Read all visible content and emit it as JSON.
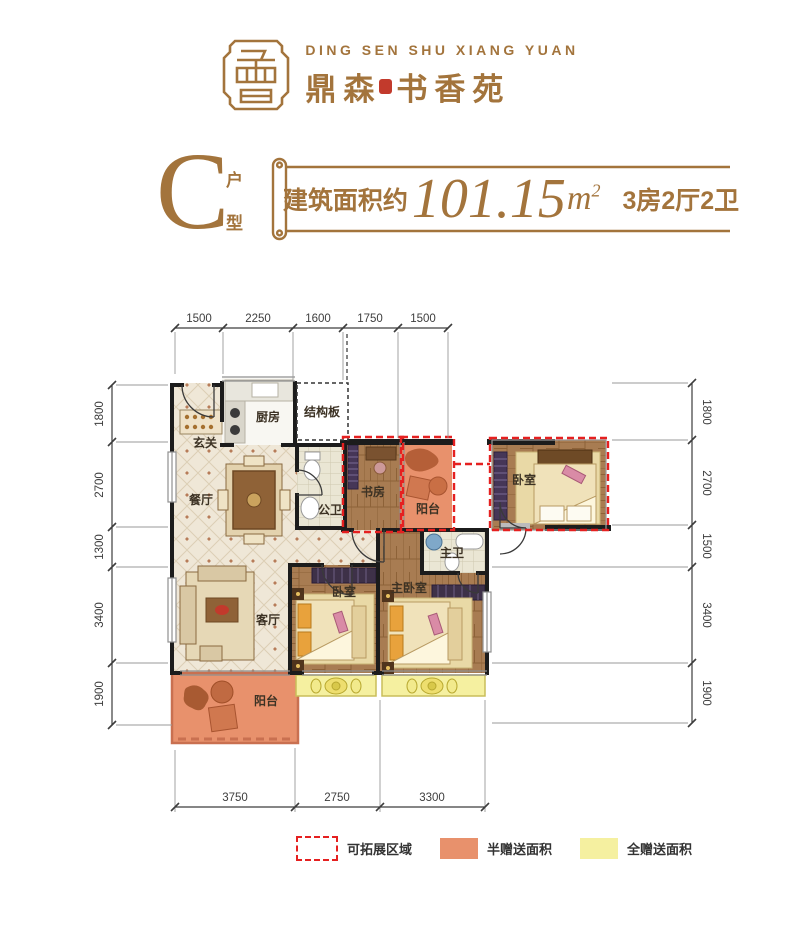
{
  "header": {
    "brand_en": "DING SEN SHU XIANG YUAN",
    "brand_cn_left": "鼎森",
    "brand_cn_right": "书香苑"
  },
  "unit": {
    "letter": "C",
    "type_top": "户",
    "type_bottom": "型",
    "area_prefix": "建筑面积约",
    "area_value": "101.15",
    "area_unit_base": "m",
    "area_unit_sup": "2",
    "layout": "3房2厅2卫"
  },
  "plan": {
    "rooms": {
      "entry": "玄关",
      "kitchen": "厨房",
      "structural": "结构板",
      "dining": "餐厅",
      "public_bath": "公卫",
      "study": "书房",
      "balcony_top": "阳台",
      "bedroom_detached": "卧室",
      "master_bath": "主卫",
      "bedroom2": "卧室",
      "master_bedroom": "主卧室",
      "living": "客厅",
      "balcony_bottom": "阳台"
    },
    "dims": {
      "top": [
        "1500",
        "2250",
        "1600",
        "1750",
        "1500"
      ],
      "left": [
        "1800",
        "2700",
        "1300",
        "3400",
        "1900"
      ],
      "right": [
        "1800",
        "2700",
        "1500",
        "3400",
        "1900"
      ],
      "bottom": [
        "3750",
        "2750",
        "3300"
      ]
    }
  },
  "legend": {
    "expandable": "可拓展区域",
    "half_gift": "半赠送面积",
    "full_gift": "全赠送面积"
  },
  "colors": {
    "gold": "#a3743c",
    "seal_red": "#c23a2c",
    "half_gift": "#e8916c",
    "full_gift": "#f5f0a0",
    "expandable_dash": "#e52020"
  }
}
